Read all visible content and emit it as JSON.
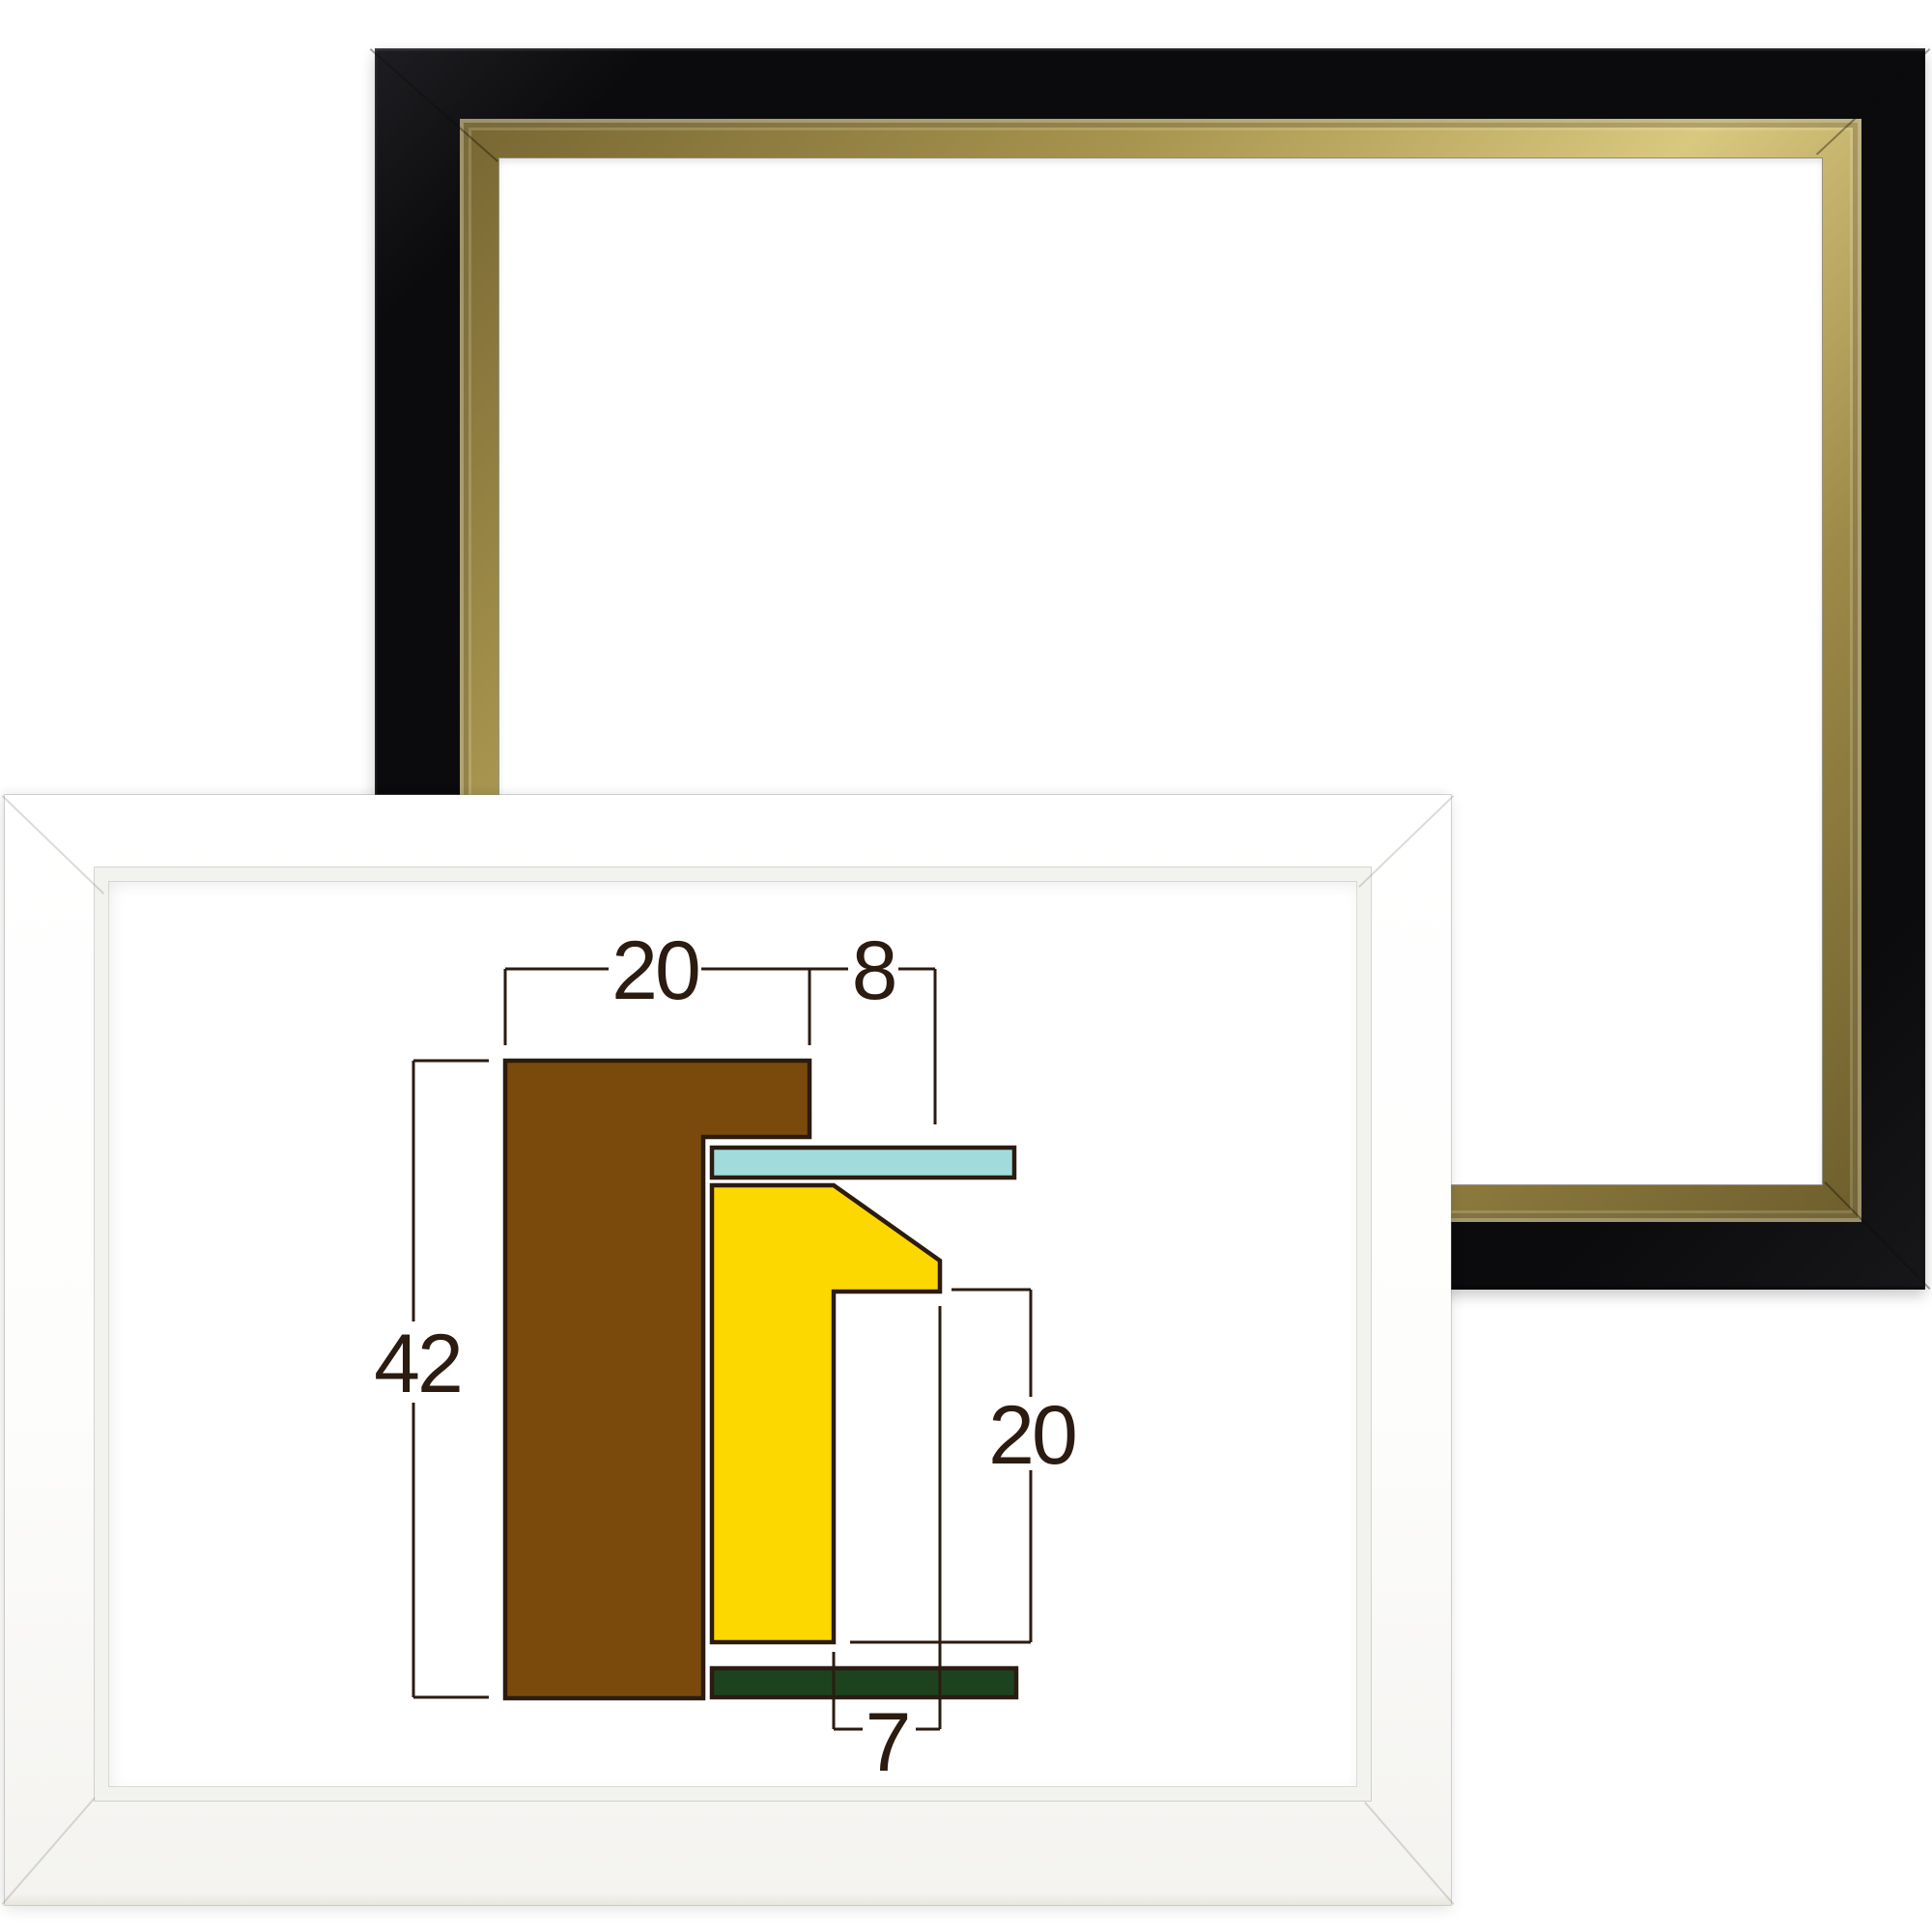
{
  "page": {
    "background": "#ffffff"
  },
  "black_frame": {
    "label": "black lacquer frame with gold liner",
    "face_color": "#0c0c0e",
    "gold_color": "#b3a05c",
    "opening_color": "#ffffff"
  },
  "white_frame": {
    "label": "white box frame",
    "face_color": "#ffffff",
    "lip_color": "#f2f2ef",
    "opening_color": "#ffffff"
  },
  "diagram": {
    "type": "frame-profile-cross-section",
    "colors": {
      "outer_wood": "#7a4a0c",
      "liner": "#fcd800",
      "glazing": "#a2dbdc",
      "backing": "#1d431e",
      "outline": "#2b1b10"
    },
    "dimensions": {
      "face_width": "20",
      "overhang": "8",
      "total_height": "42",
      "inner_depth": "20",
      "lip_width": "7"
    }
  }
}
